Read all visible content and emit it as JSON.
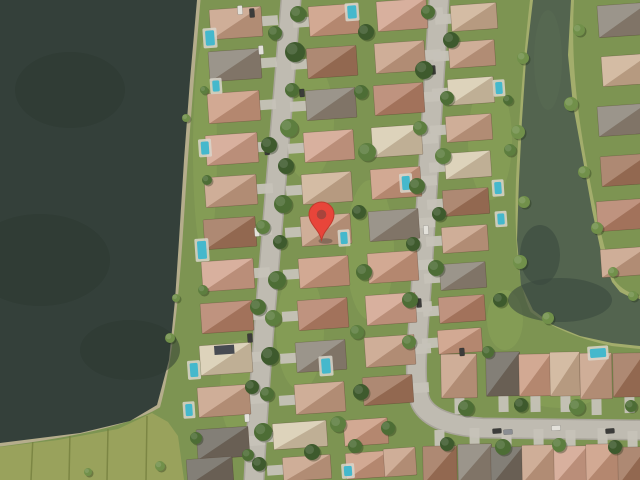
{
  "map": {
    "view_type": "satellite",
    "marker": {
      "x": 321.5,
      "y": 240,
      "body_color": "#E8453A",
      "rim_color": "#C03A2E",
      "dot_color": "#A8443C",
      "dot_r": 4.8,
      "head_r": 12.5,
      "head_cy": -25.5
    },
    "palette": {
      "grass": "#7d9452",
      "lawn_light": "#90ab5c",
      "field": "#99a25c",
      "field_line": "#75803f",
      "lake": "#34403a",
      "lake_dark": "#2c372f",
      "canal": "#53644f",
      "canal_dark": "#3a4a40",
      "sand": "#b5ad8c",
      "bank": "#a3ad6c",
      "street_edge": "#a9a59b",
      "street": "#bfbbb1",
      "driveway": "#c6c2b8",
      "pool_water": "#45b8cc",
      "pool_deck": "#d9d6cb",
      "solar_panel": "#474b52",
      "roofs": {
        "tan": "#c7a188",
        "salmon": "#cb9b82",
        "pink": "#d2a48e",
        "terra": "#b5826a",
        "brown": "#a1765c",
        "gray": "#8b8478",
        "darkgray": "#6f6b61",
        "cream": "#d8ccb0",
        "beige": "#cdb296"
      },
      "trees": [
        "#3e5a2d",
        "#4d6d35",
        "#5d7e3f",
        "#71904a"
      ],
      "cars": {
        "lt": "#e3e1da",
        "dk": "#3c3c3a",
        "md": "#8a8d92"
      }
    },
    "lake": {
      "polygon": "0,0 197,0 190,80 184,160 179,240 175,300 169,360 157,405 130,421 80,433 0,443",
      "shore_path": "M197,0 C190,80 184,160 179,240 C175,300 169,360 157,405 C130,421 80,433 0,443",
      "dark_blobs": [
        [
          70,
          90,
          55,
          38
        ],
        [
          40,
          260,
          70,
          46
        ],
        [
          130,
          350,
          50,
          30
        ]
      ]
    },
    "canal": {
      "polygon": "533,0 526,60 522,120 519,180 517,240 521,285 533,310 553,325 580,336 612,343 640,346 640,299 628,296 620,292 612,282 601,252 592,210 583,160 573,105 568,55 571,0",
      "west_bank_path": "M533,0 C526,60 522,120 519,180 C517,240 521,285 533,310 C553,325 580,336 612,343 L640,346",
      "east_bank_path": "M571,0 C568,55 573,105 583,160 C592,210 601,252 612,282 C620,292 628,296 640,299",
      "dark_blobs": [
        [
          560,
          300,
          52,
          22
        ],
        [
          540,
          255,
          20,
          30
        ]
      ],
      "light_blobs": [
        [
          548,
          60,
          14,
          50
        ]
      ]
    },
    "field": {
      "polygon": "0,447 58,440 118,429 152,413 168,422 178,436 184,480 0,480",
      "lines": [
        [
          33,
          436,
          31,
          480
        ],
        [
          70,
          432,
          69,
          480
        ],
        [
          108,
          429,
          107,
          480
        ],
        [
          147,
          416,
          146,
          480
        ]
      ]
    },
    "lawn_patches": [
      [
        308,
        120,
        26,
        60
      ],
      [
        370,
        250,
        24,
        70
      ],
      [
        490,
        140,
        22,
        60
      ],
      [
        560,
        390,
        40,
        18
      ],
      [
        300,
        330,
        24,
        60
      ],
      [
        240,
        390,
        20,
        50
      ],
      [
        205,
        150,
        12,
        110
      ],
      [
        505,
        320,
        18,
        30
      ]
    ],
    "streets": [
      {
        "path": "M291,0 C283,100 275,200 268,280 C262,350 257,420 254,480"
      },
      {
        "path": "M439,0 C433,90 427,190 421,290 C417,345 413,385 421,403 C429,419 452,426 482,428 L640,430"
      }
    ],
    "houses": [
      [
        236,
        23,
        52,
        30,
        "tan",
        "E"
      ],
      [
        235,
        65,
        52,
        30,
        "gray",
        "E"
      ],
      [
        234,
        107,
        52,
        30,
        "salmon",
        "E"
      ],
      [
        232,
        149,
        52,
        30,
        "pink",
        "E"
      ],
      [
        231,
        191,
        52,
        30,
        "tan",
        "E"
      ],
      [
        230,
        233,
        52,
        30,
        "brown",
        "E"
      ],
      [
        228,
        275,
        52,
        30,
        "pink",
        "E"
      ],
      [
        227,
        317,
        52,
        30,
        "terra",
        "E"
      ],
      [
        226,
        359,
        52,
        30,
        "cream",
        "E"
      ],
      [
        224,
        401,
        52,
        30,
        "tan",
        "E"
      ],
      [
        223,
        443,
        52,
        30,
        "darkgray",
        "E"
      ],
      [
        210,
        471,
        46,
        26,
        "darkgray",
        ""
      ],
      [
        334,
        20,
        50,
        30,
        "salmon",
        "W"
      ],
      [
        332,
        62,
        50,
        30,
        "brown",
        "W"
      ],
      [
        331,
        104,
        50,
        30,
        "gray",
        "W"
      ],
      [
        329,
        146,
        50,
        30,
        "pink",
        "W"
      ],
      [
        327,
        188,
        50,
        30,
        "beige",
        "W"
      ],
      [
        326,
        230,
        50,
        30,
        "tan",
        "W"
      ],
      [
        324,
        272,
        50,
        30,
        "salmon",
        "W"
      ],
      [
        323,
        314,
        50,
        30,
        "terra",
        "W"
      ],
      [
        321,
        356,
        50,
        30,
        "gray",
        "W"
      ],
      [
        320,
        398,
        50,
        30,
        "tan",
        "W"
      ],
      [
        300,
        435,
        54,
        26,
        "cream",
        "W"
      ],
      [
        307,
        468,
        48,
        24,
        "tan",
        "W"
      ],
      [
        402,
        15,
        50,
        30,
        "pink",
        "E"
      ],
      [
        400,
        57,
        50,
        30,
        "tan",
        "E"
      ],
      [
        399,
        99,
        50,
        30,
        "terra",
        "E"
      ],
      [
        397,
        141,
        50,
        30,
        "cream",
        "E"
      ],
      [
        396,
        183,
        50,
        30,
        "salmon",
        "E"
      ],
      [
        394,
        225,
        50,
        30,
        "gray",
        "E"
      ],
      [
        393,
        267,
        50,
        30,
        "salmon",
        "E"
      ],
      [
        391,
        309,
        50,
        30,
        "pink",
        "E"
      ],
      [
        390,
        351,
        50,
        30,
        "tan",
        "E"
      ],
      [
        388,
        390,
        50,
        28,
        "brown",
        "E"
      ],
      [
        366,
        432,
        44,
        26,
        "salmon",
        ""
      ],
      [
        368,
        465,
        44,
        26,
        "salmon",
        ""
      ],
      [
        400,
        462,
        32,
        28,
        "tan",
        ""
      ],
      [
        474,
        17,
        46,
        26,
        "beige",
        "W"
      ],
      [
        472,
        54,
        46,
        26,
        "tan",
        "W"
      ],
      [
        471,
        91,
        46,
        26,
        "cream",
        "W"
      ],
      [
        469,
        128,
        46,
        26,
        "tan",
        "W"
      ],
      [
        468,
        165,
        46,
        26,
        "cream",
        "W"
      ],
      [
        466,
        202,
        46,
        26,
        "brown",
        "W"
      ],
      [
        465,
        239,
        46,
        26,
        "tan",
        "W"
      ],
      [
        463,
        276,
        46,
        26,
        "gray",
        "W"
      ],
      [
        462,
        309,
        46,
        26,
        "terra",
        "W"
      ],
      [
        460,
        341,
        44,
        24,
        "salmon",
        "W"
      ],
      [
        624,
        20,
        52,
        32,
        "gray",
        ""
      ],
      [
        627,
        70,
        50,
        30,
        "beige",
        ""
      ],
      [
        623,
        120,
        50,
        30,
        "gray",
        ""
      ],
      [
        626,
        170,
        50,
        30,
        "brown",
        ""
      ],
      [
        622,
        215,
        50,
        30,
        "terra",
        ""
      ],
      [
        625,
        262,
        48,
        28,
        "tan",
        ""
      ],
      [
        459,
        376,
        36,
        44,
        "tan",
        "S",
        -1
      ],
      [
        503,
        374,
        34,
        44,
        "darkgray",
        "S",
        -1
      ],
      [
        535,
        375,
        32,
        42,
        "salmon",
        "S",
        -1
      ],
      [
        565,
        374,
        30,
        44,
        "beige",
        "S",
        -1
      ],
      [
        596,
        376,
        32,
        46,
        "tan",
        "S",
        -1
      ],
      [
        629,
        375,
        32,
        44,
        "brown",
        "S",
        -1
      ],
      [
        440,
        465,
        34,
        38,
        "brown",
        "N",
        -1
      ],
      [
        475,
        463,
        34,
        38,
        "gray",
        "N",
        -1
      ],
      [
        507,
        466,
        32,
        38,
        "darkgray",
        "N",
        -1
      ],
      [
        539,
        464,
        34,
        38,
        "tan",
        "N",
        -1
      ],
      [
        571,
        465,
        34,
        38,
        "pink",
        "N",
        -1
      ],
      [
        603,
        463,
        34,
        38,
        "salmon",
        "N",
        -1
      ],
      [
        633,
        466,
        30,
        38,
        "brown",
        "N",
        -1
      ]
    ],
    "solar_panels": [
      [
        214,
        346,
        20,
        9
      ]
    ],
    "pools": [
      [
        210,
        38,
        9,
        15
      ],
      [
        216,
        86,
        7,
        11
      ],
      [
        205,
        148,
        8,
        13
      ],
      [
        202,
        250,
        9,
        18
      ],
      [
        194,
        370,
        8,
        14
      ],
      [
        189,
        410,
        7,
        12
      ],
      [
        352,
        12,
        9,
        13
      ],
      [
        406,
        183,
        8,
        14
      ],
      [
        344,
        238,
        7,
        12
      ],
      [
        326,
        366,
        9,
        15
      ],
      [
        499,
        88,
        7,
        12
      ],
      [
        498,
        188,
        7,
        12
      ],
      [
        501,
        219,
        7,
        11
      ],
      [
        598,
        353,
        16,
        9
      ],
      [
        348,
        471,
        8,
        10
      ]
    ],
    "cars": [
      [
        261,
        50,
        5,
        9,
        "lt"
      ],
      [
        267,
        150,
        5,
        10,
        "dk"
      ],
      [
        257,
        232,
        5,
        9,
        "lt"
      ],
      [
        250,
        338,
        5,
        9,
        "dk"
      ],
      [
        247,
        418,
        5,
        8,
        "lt"
      ],
      [
        433,
        70,
        5,
        9,
        "dk"
      ],
      [
        426,
        230,
        5,
        9,
        "lt"
      ],
      [
        419,
        303,
        5,
        9,
        "dk"
      ],
      [
        497,
        431,
        9,
        5,
        "dk"
      ],
      [
        508,
        432,
        9,
        5,
        "md"
      ],
      [
        556,
        428,
        9,
        5,
        "lt"
      ],
      [
        610,
        431,
        9,
        5,
        "dk"
      ],
      [
        302,
        93,
        5,
        8,
        "dk"
      ],
      [
        240,
        10,
        5,
        9,
        "lt"
      ],
      [
        252,
        13,
        5,
        9,
        "dk"
      ],
      [
        462,
        352,
        5,
        8,
        "dk"
      ]
    ],
    "trees": [
      [
        298,
        14,
        8,
        1
      ],
      [
        295,
        52,
        10,
        0
      ],
      [
        292,
        90,
        7,
        1
      ],
      [
        289,
        128,
        9,
        2
      ],
      [
        286,
        166,
        8,
        0
      ],
      [
        283,
        204,
        9,
        1
      ],
      [
        280,
        242,
        7,
        0
      ],
      [
        277,
        280,
        9,
        1
      ],
      [
        273,
        318,
        8,
        2
      ],
      [
        270,
        356,
        9,
        0
      ],
      [
        267,
        394,
        7,
        1
      ],
      [
        263,
        432,
        9,
        1
      ],
      [
        259,
        464,
        7,
        0
      ],
      [
        275,
        33,
        7,
        1
      ],
      [
        269,
        145,
        8,
        0
      ],
      [
        263,
        227,
        7,
        2
      ],
      [
        258,
        307,
        8,
        1
      ],
      [
        252,
        387,
        7,
        0
      ],
      [
        248,
        455,
        6,
        1
      ],
      [
        428,
        12,
        7,
        1
      ],
      [
        424,
        70,
        9,
        0
      ],
      [
        420,
        128,
        7,
        2
      ],
      [
        417,
        186,
        8,
        1
      ],
      [
        413,
        244,
        7,
        0
      ],
      [
        410,
        300,
        8,
        1
      ],
      [
        409,
        342,
        7,
        2
      ],
      [
        451,
        40,
        8,
        0
      ],
      [
        447,
        98,
        7,
        1
      ],
      [
        443,
        156,
        8,
        2
      ],
      [
        439,
        214,
        7,
        0
      ],
      [
        436,
        268,
        8,
        1
      ],
      [
        466,
        408,
        8,
        1
      ],
      [
        521,
        405,
        7,
        0
      ],
      [
        577,
        407,
        8,
        2
      ],
      [
        631,
        406,
        6,
        1
      ],
      [
        447,
        444,
        7,
        0
      ],
      [
        503,
        447,
        8,
        1
      ],
      [
        559,
        445,
        7,
        2
      ],
      [
        615,
        447,
        7,
        0
      ],
      [
        523,
        58,
        6,
        3
      ],
      [
        518,
        132,
        7,
        3
      ],
      [
        524,
        202,
        6,
        3
      ],
      [
        520,
        262,
        7,
        3
      ],
      [
        548,
        318,
        6,
        3
      ],
      [
        579,
        30,
        6,
        3
      ],
      [
        571,
        104,
        7,
        3
      ],
      [
        584,
        172,
        6,
        3
      ],
      [
        597,
        228,
        6,
        3
      ],
      [
        613,
        272,
        5,
        3
      ],
      [
        633,
        296,
        5,
        3
      ],
      [
        366,
        32,
        8,
        0
      ],
      [
        361,
        92,
        7,
        1
      ],
      [
        367,
        152,
        9,
        2
      ],
      [
        359,
        212,
        7,
        0
      ],
      [
        364,
        272,
        8,
        1
      ],
      [
        357,
        332,
        7,
        2
      ],
      [
        361,
        392,
        8,
        0
      ],
      [
        355,
        446,
        7,
        1
      ],
      [
        186,
        118,
        4,
        3
      ],
      [
        176,
        298,
        4,
        3
      ],
      [
        170,
        338,
        5,
        3
      ],
      [
        196,
        438,
        6,
        1
      ],
      [
        160,
        466,
        5,
        3
      ],
      [
        88,
        472,
        4,
        3
      ],
      [
        312,
        452,
        8,
        0
      ],
      [
        338,
        424,
        8,
        2
      ],
      [
        388,
        428,
        7,
        1
      ],
      [
        488,
        352,
        6,
        1
      ],
      [
        500,
        300,
        7,
        0
      ],
      [
        510,
        150,
        6,
        2
      ],
      [
        508,
        100,
        5,
        1
      ],
      [
        203,
        290,
        5,
        2
      ],
      [
        207,
        180,
        5,
        1
      ],
      [
        204,
        90,
        4,
        2
      ]
    ]
  }
}
